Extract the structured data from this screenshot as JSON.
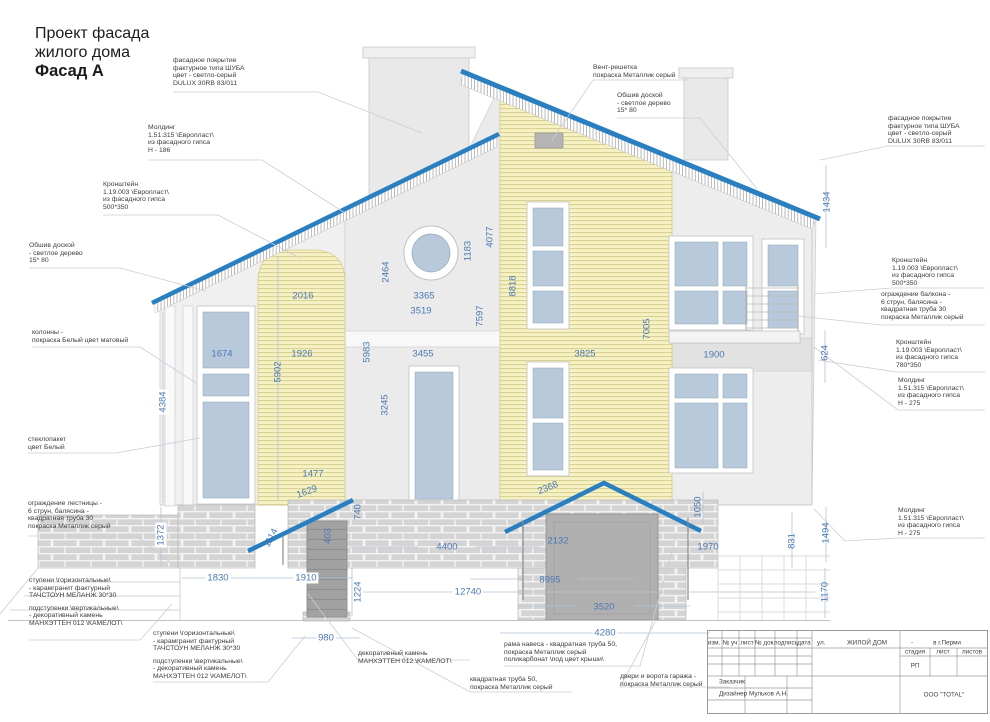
{
  "page": {
    "title_line1": "Проект фасада",
    "title_line2": "жилого дома",
    "title_line3": "Фасад А"
  },
  "colors": {
    "roof_blue": "#2a7fc0",
    "dimension_blue": "#4b79b3",
    "siding_yellow": "#f5f1c3",
    "glass_blue": "#b7c9da",
    "wall_grey": "#ebebeb",
    "brick_grey": "#d4d4d4",
    "metal_grey": "#b0b0b0"
  },
  "dimensions": [
    {
      "value": "2016"
    },
    {
      "value": "1926"
    },
    {
      "value": "5902"
    },
    {
      "value": "1674"
    },
    {
      "value": "2464"
    },
    {
      "value": "3365"
    },
    {
      "value": "3519"
    },
    {
      "value": "1183"
    },
    {
      "value": "4077"
    },
    {
      "value": "7597"
    },
    {
      "value": "5983"
    },
    {
      "value": "3455"
    },
    {
      "value": "3245"
    },
    {
      "value": "8818"
    },
    {
      "value": "7005"
    },
    {
      "value": "3825"
    },
    {
      "value": "1900"
    },
    {
      "value": "1434"
    },
    {
      "value": "624"
    },
    {
      "value": "4384"
    },
    {
      "value": "1372"
    },
    {
      "value": "1830"
    },
    {
      "value": "1477"
    },
    {
      "value": "1629"
    },
    {
      "value": "740"
    },
    {
      "value": "1114"
    },
    {
      "value": "403"
    },
    {
      "value": "1910"
    },
    {
      "value": "1224"
    },
    {
      "value": "980"
    },
    {
      "value": "4400"
    },
    {
      "value": "12740"
    },
    {
      "value": "2368"
    },
    {
      "value": "2132"
    },
    {
      "value": "8995"
    },
    {
      "value": "3520"
    },
    {
      "value": "4280"
    },
    {
      "value": "1050"
    },
    {
      "value": "1970"
    },
    {
      "value": "831"
    },
    {
      "value": "1494"
    },
    {
      "value": "1170"
    }
  ],
  "annotations": [
    {
      "id": "facade_top",
      "lines": [
        "фасадное покрытие",
        "фактурное типа ШУБА",
        "цвет - светло-серый",
        "DULUX 30RB 83/011"
      ]
    },
    {
      "id": "molding_left",
      "lines": [
        "Молдинг",
        "1.51.315 \\Европласт\\",
        "из фасадного гипса",
        "Н -  186"
      ]
    },
    {
      "id": "bracket_left",
      "lines": [
        "Кронштейн",
        "1.19.003 \\Европласт\\",
        "из фасадного гипса",
        "500*350"
      ]
    },
    {
      "id": "plank_left",
      "lines": [
        "Обшив доской",
        "- светлое дерево",
        "15* 80"
      ]
    },
    {
      "id": "columns",
      "lines": [
        "колонны -",
        "покраска Белый цвет матовый"
      ]
    },
    {
      "id": "glazing",
      "lines": [
        "стеклопакет",
        "цвет Белый"
      ]
    },
    {
      "id": "stair_rail",
      "lines": [
        "ограждение лестницы -",
        "6 струн, балясина -",
        "квадратная труба 30",
        "покраска Металлик серый"
      ]
    },
    {
      "id": "steps_left",
      "lines": [
        "ступени \\горизонтальные\\",
        " - карамгранит фактурный",
        "ТАЧСТОУН МЕЛАНЖ 30*30",
        "",
        "подступенки \\вертикальные\\",
        "- декоративный камень",
        "МАНХЭТТЕН 012 \\КАМЕЛОТ\\"
      ]
    },
    {
      "id": "steps_left2",
      "lines": [
        "ступени \\горизонтальные\\",
        " - карамгранит фактурный",
        "ТАЧСТОУН МЕЛАНЖ 30*30",
        "",
        "подступенки \\вертикальные\\",
        "- декоративный камень",
        "МАНХЭТТЕН 012 \\КАМЕЛОТ\\"
      ]
    },
    {
      "id": "vent",
      "lines": [
        "Вент-решетка",
        "покраска Металлик серый"
      ]
    },
    {
      "id": "plank_top",
      "lines": [
        "Обшив доской",
        "- светлое дерево",
        "15* 80"
      ]
    },
    {
      "id": "facade_right",
      "lines": [
        "фасадное покрытие",
        "фактурное типа ШУБА",
        "цвет - светло-серый",
        "DULUX 30RB 83/011"
      ]
    },
    {
      "id": "bracket_right_500",
      "lines": [
        "Кронштейн",
        "1.19.003 \\Европласт\\",
        "из фасадного гипса",
        "500*350"
      ]
    },
    {
      "id": "balcony_rail",
      "lines": [
        "ограждение балкона -",
        "6 струн, балясина -",
        "квадратная труба 30",
        "покраска Металлик серый"
      ]
    },
    {
      "id": "bracket_right_780",
      "lines": [
        "Кронштейн",
        "1.19.003 \\Европласт\\",
        "из фасадного гипса",
        "780*350"
      ]
    },
    {
      "id": "molding_right_1",
      "lines": [
        "Молдинг",
        "1.51.315 \\Европласт\\",
        "из фасадного гипса",
        "Н - 275"
      ]
    },
    {
      "id": "molding_right_2",
      "lines": [
        "Молдинг",
        "1.51.315 \\Европласт\\",
        "из фасадного гипса",
        "Н - 275"
      ]
    },
    {
      "id": "stone",
      "lines": [
        "декоративный камень",
        "МАНХЭТТЕН 012 \\КАМЕЛОТ\\"
      ]
    },
    {
      "id": "pipe50",
      "lines": [
        "квадратная труба 50,",
        "покраска Металлик серый"
      ]
    },
    {
      "id": "canopy_frame",
      "lines": [
        "рама навеса - квадратная труба 50,",
        "покраска Металлик серый",
        "поликарбонат \\под цвет крыши\\"
      ]
    },
    {
      "id": "garage_doors",
      "lines": [
        "двери и ворота гаража -",
        "покраска Металлик серый"
      ]
    }
  ],
  "title_block": {
    "cols": [
      "изм.",
      "№ уч",
      "лист",
      "№ док.",
      "подпись",
      "дата"
    ],
    "street_label": "ул.",
    "project": "ЖИЛОЙ ДОМ",
    "dash": "-",
    "city": "в г.Перми",
    "stage_label": "стадия",
    "sheet_label": "лист",
    "sheets_label": "листов",
    "stage_value": "РП",
    "customer_label": "Заказчик",
    "designer_label": "Дизайнер",
    "designer_name": "Мульков А.Н.",
    "company": "ООО \"TOTAL\""
  }
}
